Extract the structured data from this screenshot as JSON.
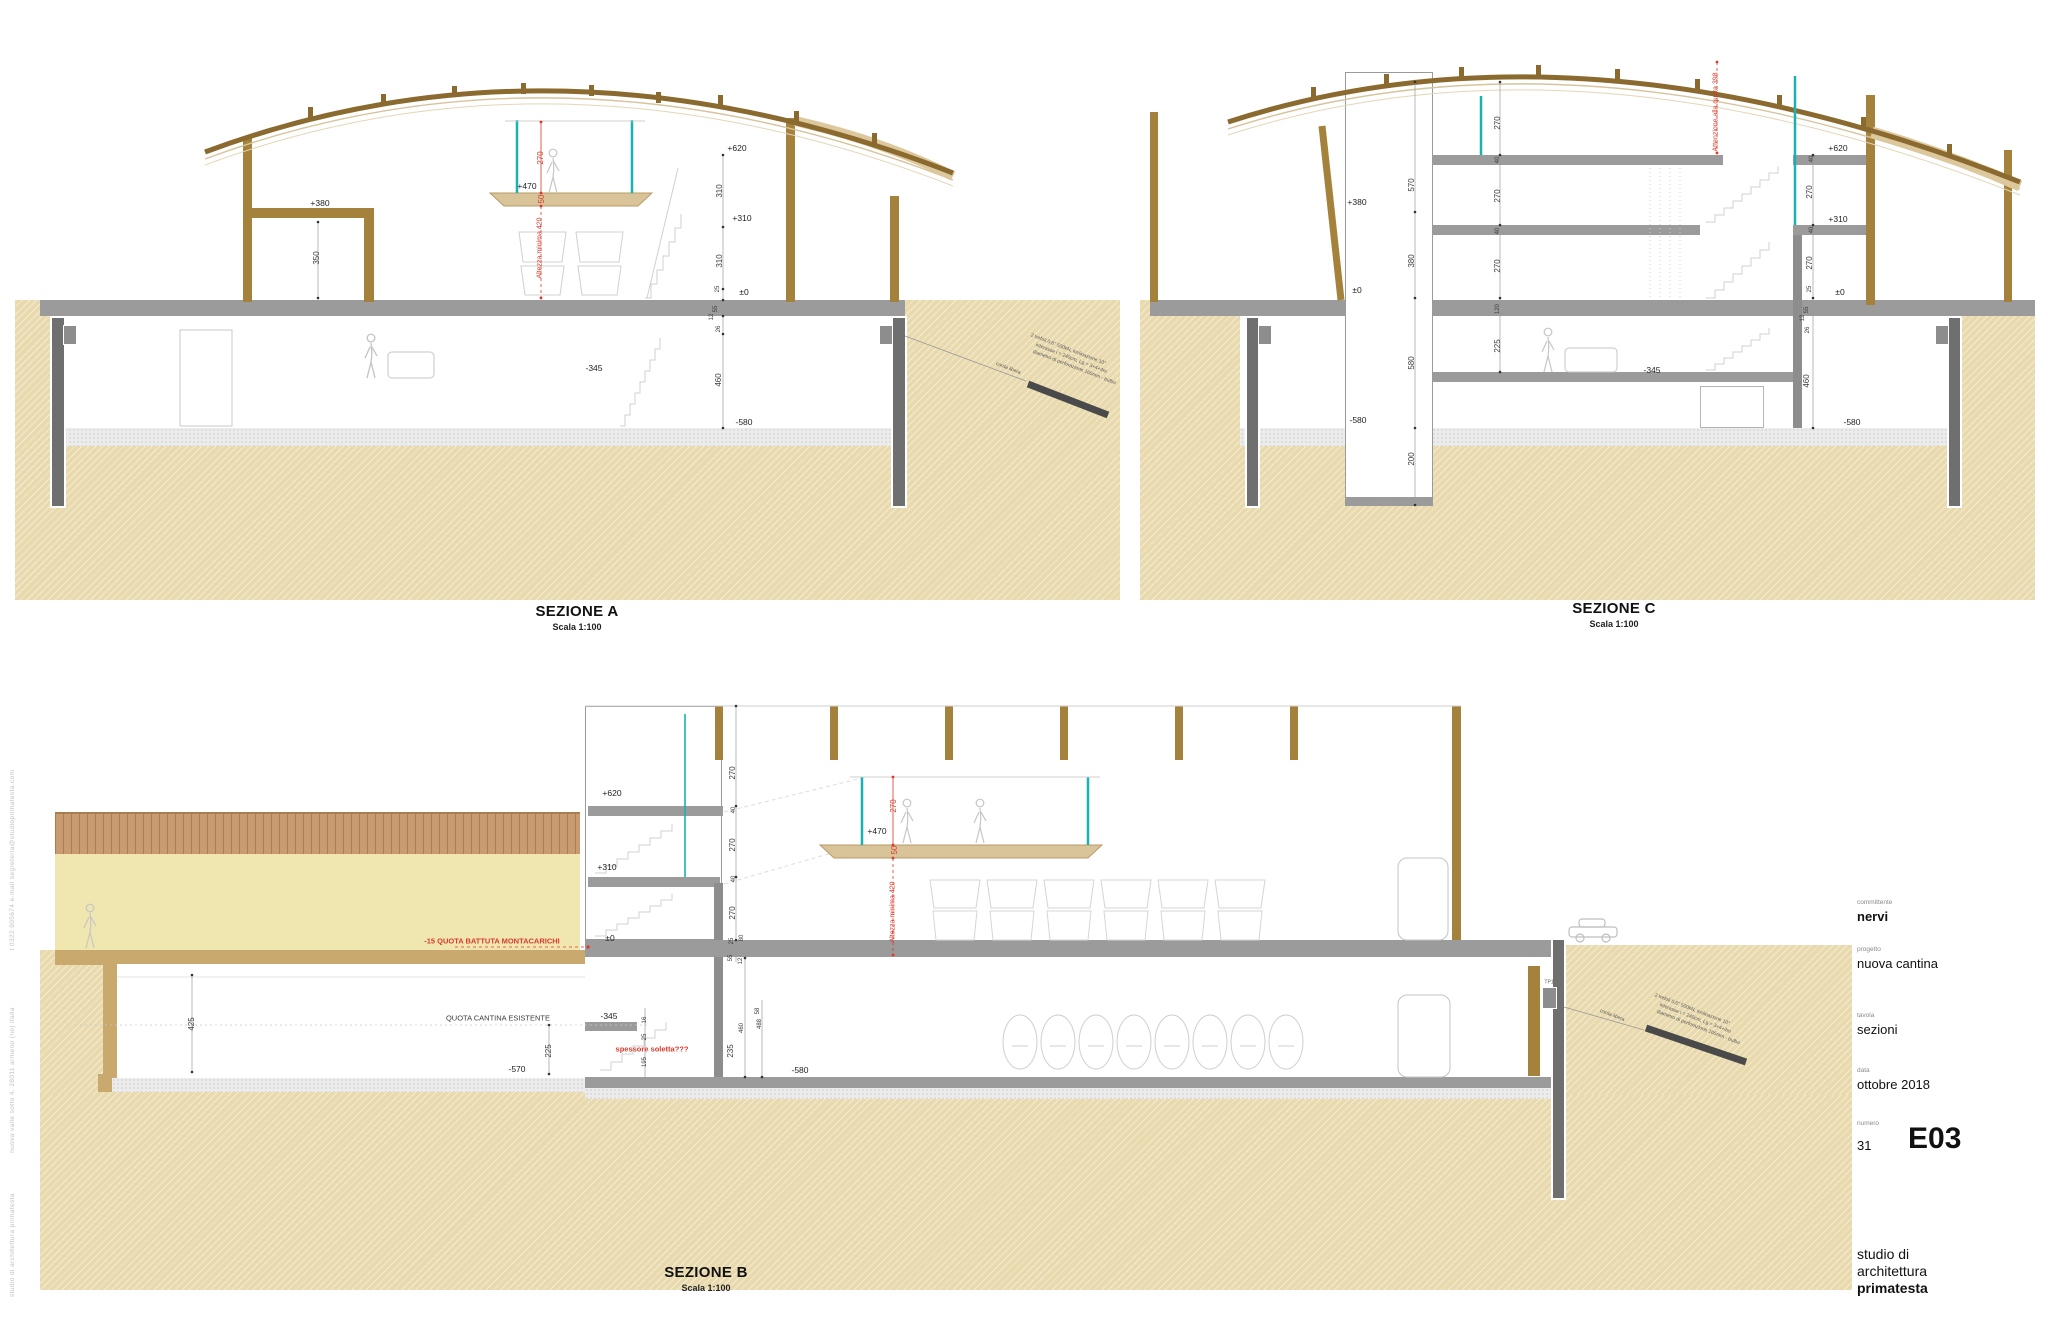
{
  "titleblock": {
    "committente_label": "committente",
    "committente": "nervi",
    "progetto_label": "progetto",
    "progetto": "nuova cantina",
    "tavola_label": "tavola",
    "tavola": "sezioni",
    "data_label": "data",
    "data": "ottobre 2018",
    "numero_label": "numero",
    "numero": "31",
    "codice": "E03",
    "studio_line1": "studio di",
    "studio_line2": "architettura",
    "studio_line3": "primatesta"
  },
  "sections": {
    "a": {
      "title": "SEZIONE A",
      "scale": "Scala 1:100"
    },
    "c": {
      "title": "SEZIONE C",
      "scale": "Scala 1:100"
    },
    "b": {
      "title": "SEZIONE B",
      "scale": "Scala 1:100"
    }
  },
  "colors": {
    "earth": "#e9daae",
    "wood": "#a5823c",
    "roof": "#8a6a2f",
    "slab": "#9b9b9b",
    "pile": "#6f6f6f",
    "glass": "#19b1b1",
    "red": "#d93a2b",
    "cream": "#f0e6b0",
    "pergola": "#c99c70"
  },
  "annotations": [
    {
      "t": "+380",
      "x": 320,
      "y": 203,
      "cls": "lvl",
      "n": "level-a-plus380"
    },
    {
      "t": "350",
      "x": 317,
      "y": 258,
      "r": -90,
      "cls": "dim"
    },
    {
      "t": "+470",
      "x": 527,
      "y": 186,
      "cls": "lvl",
      "n": "level-a-plus470"
    },
    {
      "t": "270",
      "x": 541,
      "y": 158,
      "r": -90,
      "cls": "redv"
    },
    {
      "t": "50",
      "x": 542,
      "y": 199,
      "r": -90,
      "cls": "redv"
    },
    {
      "t": "Altezza minima 420",
      "x": 540,
      "y": 248,
      "r": -90,
      "cls": "redv",
      "fs": 7,
      "n": "note-a-altezza-minima"
    },
    {
      "t": "+620",
      "x": 737,
      "y": 148,
      "cls": "lvl",
      "n": "level-a-plus620"
    },
    {
      "t": "310",
      "x": 720,
      "y": 191,
      "r": -90,
      "cls": "dim"
    },
    {
      "t": "+310",
      "x": 742,
      "y": 218,
      "cls": "lvl",
      "n": "level-a-plus310"
    },
    {
      "t": "310",
      "x": 720,
      "y": 261,
      "r": -90,
      "cls": "dim"
    },
    {
      "t": "25",
      "x": 718,
      "y": 289,
      "r": -90,
      "cls": "dim",
      "fs": 6
    },
    {
      "t": "±0",
      "x": 744,
      "y": 292,
      "cls": "lvl",
      "n": "level-a-zero"
    },
    {
      "t": "55",
      "x": 716,
      "y": 309,
      "r": -90,
      "cls": "dim",
      "fs": 6
    },
    {
      "t": "12",
      "x": 712,
      "y": 317,
      "r": -90,
      "cls": "dim",
      "fs": 6
    },
    {
      "t": "26",
      "x": 719,
      "y": 329,
      "r": -90,
      "cls": "dim",
      "fs": 6
    },
    {
      "t": "460",
      "x": 719,
      "y": 380,
      "r": -90,
      "cls": "dim"
    },
    {
      "t": "-580",
      "x": 744,
      "y": 422,
      "cls": "lvl",
      "n": "level-a-minus580"
    },
    {
      "t": "-345",
      "x": 594,
      "y": 368,
      "cls": "lvl",
      "n": "level-a-minus345"
    },
    {
      "t": "corda libera",
      "x": 1008,
      "y": 369,
      "r": 21,
      "cls": "tiny"
    },
    {
      "t": "2 trefoli 0,6\" 500kN, inclinazione 10°",
      "x": 1068,
      "y": 350,
      "r": 21,
      "cls": "tiny",
      "n": "note-a-anchor"
    },
    {
      "t": "interasse i = 240cm, Lg = 3+4+4m",
      "x": 1071,
      "y": 359,
      "r": 21,
      "cls": "tiny"
    },
    {
      "t": "diametro di perforazione 165mm - bulbo",
      "x": 1074,
      "y": 368,
      "r": 21,
      "cls": "tiny"
    },
    {
      "t": "570",
      "x": 1412,
      "y": 185,
      "r": -90,
      "cls": "dim"
    },
    {
      "t": "+380",
      "x": 1357,
      "y": 202,
      "cls": "lvl",
      "n": "level-c-plus380"
    },
    {
      "t": "380",
      "x": 1412,
      "y": 261,
      "r": -90,
      "cls": "dim"
    },
    {
      "t": "±0",
      "x": 1357,
      "y": 290,
      "cls": "lvl",
      "n": "level-c-zero-left"
    },
    {
      "t": "580",
      "x": 1412,
      "y": 363,
      "r": -90,
      "cls": "dim"
    },
    {
      "t": "-580",
      "x": 1358,
      "y": 420,
      "cls": "lvl",
      "n": "level-c-minus580-left"
    },
    {
      "t": "200",
      "x": 1412,
      "y": 459,
      "r": -90,
      "cls": "dim"
    },
    {
      "t": "270",
      "x": 1498,
      "y": 123,
      "r": -90,
      "cls": "dim"
    },
    {
      "t": "40",
      "x": 1498,
      "y": 160,
      "r": -90,
      "cls": "dim",
      "fs": 6
    },
    {
      "t": "270",
      "x": 1498,
      "y": 196,
      "r": -90,
      "cls": "dim"
    },
    {
      "t": "40",
      "x": 1498,
      "y": 231,
      "r": -90,
      "cls": "dim",
      "fs": 6
    },
    {
      "t": "270",
      "x": 1498,
      "y": 266,
      "r": -90,
      "cls": "dim"
    },
    {
      "t": "120",
      "x": 1498,
      "y": 309,
      "r": -90,
      "cls": "dim",
      "fs": 6
    },
    {
      "t": "225",
      "x": 1498,
      "y": 346,
      "r": -90,
      "cls": "dim"
    },
    {
      "t": "Attenzione alla quota 398",
      "x": 1716,
      "y": 112,
      "r": -90,
      "cls": "redv",
      "fs": 7,
      "n": "note-c-attenzione"
    },
    {
      "t": "+620",
      "x": 1838,
      "y": 148,
      "cls": "lvl",
      "n": "level-c-plus620"
    },
    {
      "t": "40",
      "x": 1812,
      "y": 159,
      "r": -90,
      "cls": "dim",
      "fs": 6
    },
    {
      "t": "270",
      "x": 1810,
      "y": 192,
      "r": -90,
      "cls": "dim"
    },
    {
      "t": "+310",
      "x": 1838,
      "y": 219,
      "cls": "lvl",
      "n": "level-c-plus310"
    },
    {
      "t": "40",
      "x": 1812,
      "y": 230,
      "r": -90,
      "cls": "dim",
      "fs": 6
    },
    {
      "t": "270",
      "x": 1810,
      "y": 263,
      "r": -90,
      "cls": "dim"
    },
    {
      "t": "25",
      "x": 1810,
      "y": 289,
      "r": -90,
      "cls": "dim",
      "fs": 6
    },
    {
      "t": "±0",
      "x": 1840,
      "y": 292,
      "cls": "lvl",
      "n": "level-c-zero-right"
    },
    {
      "t": "55",
      "x": 1807,
      "y": 310,
      "r": -90,
      "cls": "dim",
      "fs": 6
    },
    {
      "t": "12",
      "x": 1803,
      "y": 318,
      "r": -90,
      "cls": "dim",
      "fs": 6
    },
    {
      "t": "26",
      "x": 1808,
      "y": 330,
      "r": -90,
      "cls": "dim",
      "fs": 6
    },
    {
      "t": "460",
      "x": 1807,
      "y": 381,
      "r": -90,
      "cls": "dim"
    },
    {
      "t": "-580",
      "x": 1852,
      "y": 422,
      "cls": "lvl",
      "n": "level-c-minus580-right"
    },
    {
      "t": "-345",
      "x": 1652,
      "y": 370,
      "cls": "lvl",
      "n": "level-c-minus345"
    },
    {
      "t": "-15 QUOTA BATTUTA MONTACARICHI",
      "x": 492,
      "y": 941,
      "cls": "red",
      "fs": 7.5,
      "n": "note-b-montacarichi"
    },
    {
      "t": "QUOTA CANTINA ESISTENTE",
      "x": 498,
      "y": 1018,
      "cls": "dim",
      "fs": 7.5,
      "n": "note-b-quota-cantina"
    },
    {
      "t": "425",
      "x": 192,
      "y": 1024,
      "r": -90,
      "cls": "dim"
    },
    {
      "t": "225",
      "x": 549,
      "y": 1051,
      "r": -90,
      "cls": "dim"
    },
    {
      "t": "-570",
      "x": 517,
      "y": 1069,
      "cls": "lvl",
      "n": "level-b-minus570"
    },
    {
      "t": "-345",
      "x": 609,
      "y": 1016,
      "cls": "lvl",
      "n": "level-b-minus345"
    },
    {
      "t": "16",
      "x": 645,
      "y": 1020,
      "r": -90,
      "cls": "dim",
      "fs": 6
    },
    {
      "t": "25",
      "x": 645,
      "y": 1037,
      "r": -90,
      "cls": "dim",
      "fs": 6
    },
    {
      "t": "spessore soletta???",
      "x": 652,
      "y": 1049,
      "cls": "red",
      "fs": 7.5,
      "n": "note-b-spessore-soletta"
    },
    {
      "t": "195",
      "x": 645,
      "y": 1062,
      "r": -90,
      "cls": "dim",
      "fs": 6
    },
    {
      "t": "+620",
      "x": 612,
      "y": 793,
      "cls": "lvl",
      "n": "level-b-plus620"
    },
    {
      "t": "+310",
      "x": 607,
      "y": 867,
      "cls": "lvl",
      "n": "level-b-plus310"
    },
    {
      "t": "±0",
      "x": 610,
      "y": 938,
      "cls": "lvl",
      "n": "level-b-zero"
    },
    {
      "t": "270",
      "x": 733,
      "y": 773,
      "r": -90,
      "cls": "dim"
    },
    {
      "t": "40",
      "x": 734,
      "y": 810,
      "r": -90,
      "cls": "dim",
      "fs": 6
    },
    {
      "t": "270",
      "x": 733,
      "y": 845,
      "r": -90,
      "cls": "dim"
    },
    {
      "t": "40",
      "x": 734,
      "y": 879,
      "r": -90,
      "cls": "dim",
      "fs": 6
    },
    {
      "t": "270",
      "x": 733,
      "y": 913,
      "r": -90,
      "cls": "dim"
    },
    {
      "t": "25",
      "x": 732,
      "y": 941,
      "r": -90,
      "cls": "dim",
      "fs": 6
    },
    {
      "t": "80",
      "x": 742,
      "y": 938,
      "r": -90,
      "cls": "dim",
      "fs": 6
    },
    {
      "t": "55",
      "x": 731,
      "y": 958,
      "r": -90,
      "cls": "dim",
      "fs": 6
    },
    {
      "t": "12",
      "x": 741,
      "y": 961,
      "r": -90,
      "cls": "dim",
      "fs": 6
    },
    {
      "t": "58",
      "x": 758,
      "y": 1011,
      "r": -90,
      "cls": "dim",
      "fs": 6
    },
    {
      "t": "488",
      "x": 760,
      "y": 1024,
      "r": -90,
      "cls": "dim",
      "fs": 6
    },
    {
      "t": "460",
      "x": 742,
      "y": 1028,
      "r": -90,
      "cls": "dim",
      "fs": 6
    },
    {
      "t": "235",
      "x": 731,
      "y": 1051,
      "r": -90,
      "cls": "dim"
    },
    {
      "t": "-580",
      "x": 800,
      "y": 1070,
      "cls": "lvl",
      "n": "level-b-minus580"
    },
    {
      "t": "+470",
      "x": 877,
      "y": 831,
      "cls": "lvl",
      "n": "level-b-plus470"
    },
    {
      "t": "270",
      "x": 894,
      "y": 806,
      "r": -90,
      "cls": "redv"
    },
    {
      "t": "50",
      "x": 895,
      "y": 850,
      "r": -90,
      "cls": "redv"
    },
    {
      "t": "Altezza minima 420",
      "x": 893,
      "y": 912,
      "r": -90,
      "cls": "redv",
      "fs": 7,
      "n": "note-b-altezza-minima"
    },
    {
      "t": "TP1",
      "x": 1549,
      "y": 983,
      "cls": "tiny",
      "fs": 5
    },
    {
      "t": "corda libera",
      "x": 1612,
      "y": 1016,
      "r": 21,
      "cls": "tiny"
    },
    {
      "t": "2 trefoli 0,6\" 500kN, inclinazione 10°",
      "x": 1692,
      "y": 1010,
      "r": 21,
      "cls": "tiny",
      "n": "note-b-anchor"
    },
    {
      "t": "interasse i = 240cm, Lg = 3+4+4m",
      "x": 1695,
      "y": 1019,
      "r": 21,
      "cls": "tiny"
    },
    {
      "t": "diametro di perforazione 165mm - bulbo",
      "x": 1698,
      "y": 1028,
      "r": 21,
      "cls": "tiny"
    },
    {
      "t": "studio di architettura primatesta",
      "x": 13,
      "y": 1245,
      "r": -90,
      "cls": "margin",
      "n": "margin-studio"
    },
    {
      "t": "nuova valle sotto 4, 28011 armeno (no) italia",
      "x": 13,
      "y": 1080,
      "r": -90,
      "cls": "margin",
      "n": "margin-address"
    },
    {
      "t": "t 0322 905674 e-mail segreteria@studioprimatesta.com",
      "x": 13,
      "y": 860,
      "r": -90,
      "cls": "margin",
      "n": "margin-contact"
    }
  ]
}
